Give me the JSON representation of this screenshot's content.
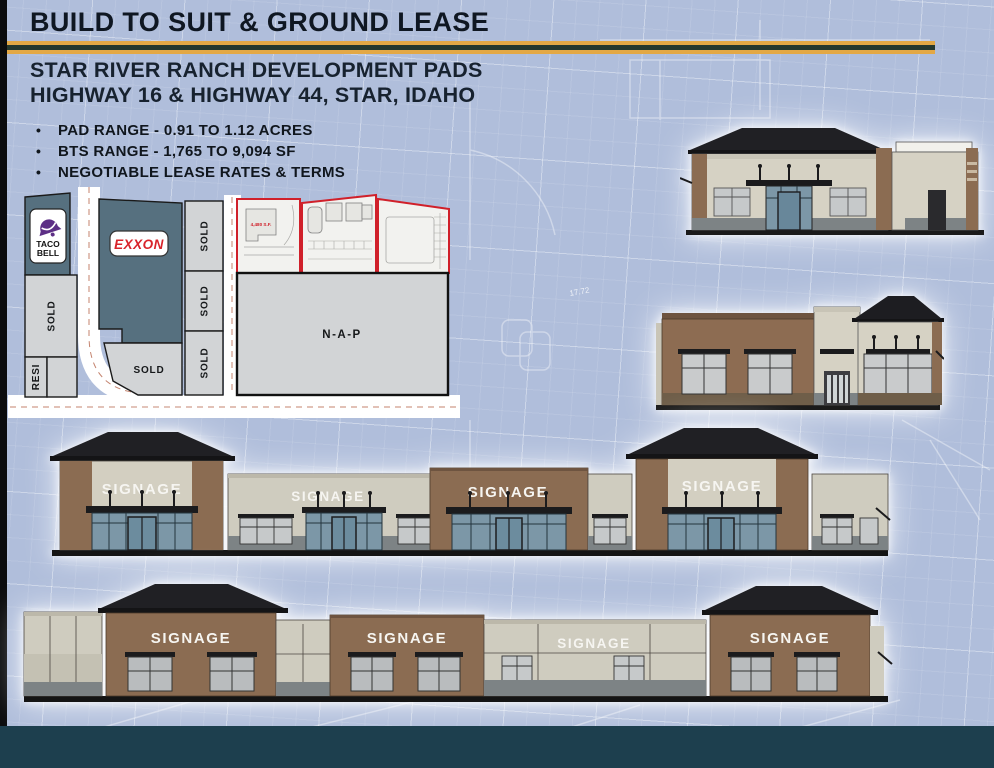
{
  "header": {
    "title": "BUILD TO SUIT & GROUND LEASE",
    "subtitle_line1": "STAR RIVER RANCH DEVELOPMENT PADS",
    "subtitle_line2": "HIGHWAY 16 & HIGHWAY 44, STAR, IDAHO",
    "bullets": [
      "PAD RANGE - 0.91 TO 1.12 ACRES",
      "BTS RANGE - 1,765 TO 9,094 SF",
      "NEGOTIABLE LEASE RATES & TERMS"
    ]
  },
  "site_plan": {
    "taco_bell_line1": "TACO",
    "taco_bell_line2": "BELL",
    "exxon_label": "EXXON",
    "sold_label": "SOLD",
    "resi_label": "RESI",
    "nap_label": "N-A-P",
    "pad_sf_label": "4,480 S.F."
  },
  "elevations": {
    "signage_label": "SIGNAGE"
  },
  "background": {
    "dim_note": "17.72"
  },
  "colors": {
    "background_blue": "#b0bedb",
    "accent_gold": "#e3a845",
    "accent_dark_green": "#25382e",
    "footer_teal": "#1d3f4e",
    "parcel_slate": "#56707f",
    "parcel_gray": "#d2d4d6",
    "pad_outline_red": "#d0202a",
    "wall_brown": "#8b6c52",
    "wall_beige": "#d3cfc1",
    "roof_dark": "#202024",
    "storefront_glass": "#7c97a7",
    "exxon_red": "#d8232a",
    "taco_bell_purple": "#5d2f86"
  }
}
